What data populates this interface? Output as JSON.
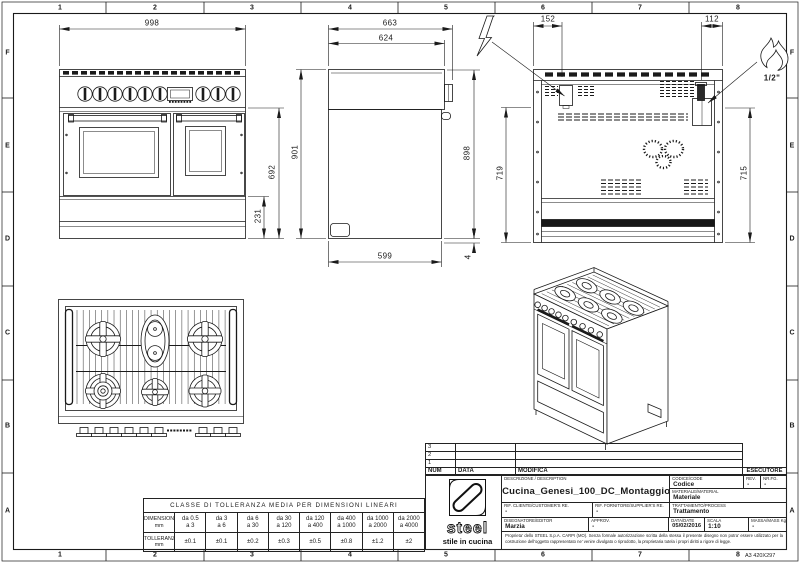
{
  "sheet": {
    "grid_cols": [
      "1",
      "2",
      "3",
      "4",
      "5",
      "6",
      "7",
      "8"
    ],
    "grid_rows": [
      "F",
      "E",
      "D",
      "C",
      "B",
      "A"
    ],
    "format_note": "A3 420X297"
  },
  "dims": {
    "front_width": "998",
    "front_height": "692",
    "front_plinth": "231",
    "side_depth": "663",
    "side_top_depth": "624",
    "side_height": "901",
    "side_back_height": "898",
    "side_base_depth": "599",
    "side_gap": "4",
    "back_left_offset": "152",
    "back_right_offset": "112",
    "back_left_height": "719",
    "back_right_height": "715",
    "gas": "1/2\""
  },
  "tolerance_table": {
    "title": "CLASSE DI TOLLERANZA MEDIA PER DIMENSIONI LINEARI",
    "dim_label": "DIMENSIONI",
    "tol_label": "TOLLERANZA",
    "unit": "mm",
    "ranges": [
      [
        "da 0.5",
        "a 3"
      ],
      [
        "da 3",
        "a 6"
      ],
      [
        "da 6",
        "a 30"
      ],
      [
        "da 30",
        "a 120"
      ],
      [
        "da 120",
        "a 400"
      ],
      [
        "da 400",
        "a 1000"
      ],
      [
        "da 1000",
        "a 2000"
      ],
      [
        "da 2000",
        "a 4000"
      ]
    ],
    "tolerances": [
      "±0.1",
      "±0.1",
      "±0.2",
      "±0.3",
      "±0.5",
      "±0.8",
      "±1.2",
      "±2"
    ]
  },
  "title_block": {
    "rev_rows": [
      "3",
      "2",
      "1"
    ],
    "num_header": "NUM",
    "data_header": "DATA",
    "modifica_header": "MODIFICA",
    "esecutore_header": "ESECUTORE",
    "descrizione_label": "DESCRIZIONE / DESCRIPTION",
    "descrizione_value": "Cucina_Genesi_100_DC_Montaggio",
    "codice_label": "CODICE/CODE",
    "codice_value": "Codice",
    "rev_label": "REV.",
    "rev_value": "-",
    "fg_label": "NR.FG.",
    "fg_value": "-",
    "materiale_label": "MATERIALE/MATERIAL",
    "materiale_value": "Materiale",
    "rif_cliente_label": "RIF. CLIENTE/CUSTOMER'S RE.",
    "rif_cliente_value": "-",
    "rif_fornitore_label": "RIF. FORNITORE/SUPPLIER'S RE.",
    "rif_fornitore_value": "-",
    "trattamento_label": "TRATTAMENTO/PROCESS",
    "trattamento_value": "Trattamento",
    "disegnatore_label": "DISEGNATORE/EDITOR",
    "disegnatore_value": "Marzia",
    "approv_label": "APPROV.",
    "approv_value": "-",
    "data_label": "DATA/DATE",
    "data_value": "05/02/2016",
    "scala_label": "SCALA",
    "scala_value": "1:10",
    "massa_label": "MASSA/MASS Kg",
    "massa_value": "-",
    "legal": "Proprieta' dello STEEL S.p.A. CARPI (MO). Senza formale autorizzazione scritta della stessa il presente disegno non potra' essere utilizzato per la costruzione dell'oggetto rappresentato ne' venire divulgato o riprodotto, la proprietaria tutela i propri diritti a rigore di legge.",
    "logo_text": "steel",
    "logo_tagline": "stile in cucina"
  }
}
